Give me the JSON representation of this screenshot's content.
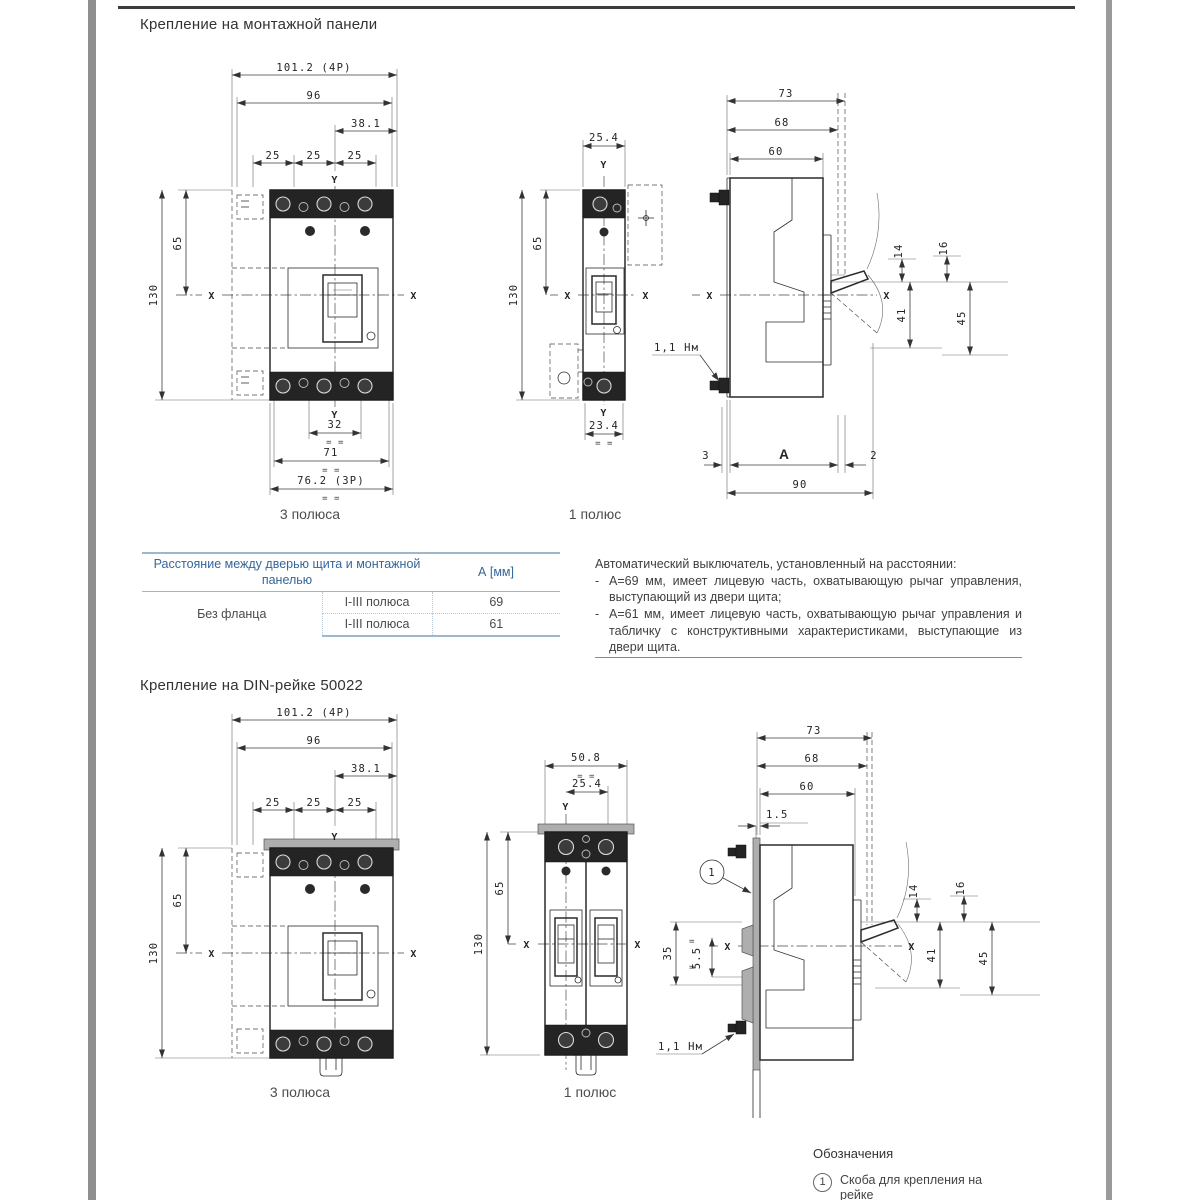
{
  "sym": {
    "x": "X",
    "y": "Y",
    "eq": "= =",
    "eqs": "=",
    "dash": "-"
  },
  "sections": [
    {
      "title": "Крепление на монтажной панели",
      "front3": {
        "label": "3 полюса",
        "d": {
          "w4p": "101.2 (4P)",
          "w96": "96",
          "w381": "38.1",
          "p1": "25",
          "p2": "25",
          "p3": "25",
          "h65": "65",
          "h130": "130",
          "b32": "32",
          "b71": "71",
          "b762": "76.2 (3P)"
        }
      },
      "front1": {
        "label": "1 полюс",
        "d": {
          "w254": "25.4",
          "h65": "65",
          "h130": "130",
          "b234": "23.4"
        }
      },
      "side": {
        "torque": "1,1 Нм",
        "d": {
          "d73": "73",
          "d68": "68",
          "d60": "60",
          "d14": "14",
          "d16": "16",
          "d41": "41",
          "d45": "45",
          "d3": "3",
          "dA": "A",
          "d2": "2",
          "d90": "90"
        }
      },
      "table": {
        "col1_header": "Расстояние между дверью щита и монтажной панелью",
        "colA_header": "А [мм]",
        "rows": [
          {
            "group": "Без фланца",
            "poles": "I-III полюса",
            "value": "69"
          },
          {
            "poles": "I-III полюса",
            "value": "61"
          }
        ]
      },
      "note": {
        "intro": "Автоматический выключатель, установленный на расстоянии:",
        "items": [
          "А=69 мм, имеет лицевую часть, охватывающую рычаг управления, выступающий из двери щита;",
          "А=61 мм, имеет лицевую часть, охватывающую рычаг управления и табличку с конструктивными характеристиками, выступающие из двери щита."
        ]
      }
    },
    {
      "title": "Крепление на DIN-рейке 50022",
      "front3": {
        "label": "3 полюса",
        "d": {
          "w4p": "101.2 (4P)",
          "w96": "96",
          "w381": "38.1",
          "p1": "25",
          "p2": "25",
          "p3": "25",
          "h65": "65",
          "h130": "130"
        }
      },
      "front1": {
        "label": "1 полюс",
        "d": {
          "w508": "50.8",
          "w254": "25.4",
          "h65": "65",
          "h130": "130"
        }
      },
      "side": {
        "torque": "1,1 Нм",
        "callout": "1",
        "d": {
          "d73": "73",
          "d68": "68",
          "d60": "60",
          "d15": "1.5",
          "d35": "35",
          "d55": "5.5",
          "d14": "14",
          "d16": "16",
          "d41": "41",
          "d45": "45"
        }
      },
      "legend": {
        "title": "Обозначения",
        "item1_num": "1",
        "item1_text": "Скоба для крепления на рейке"
      }
    }
  ]
}
